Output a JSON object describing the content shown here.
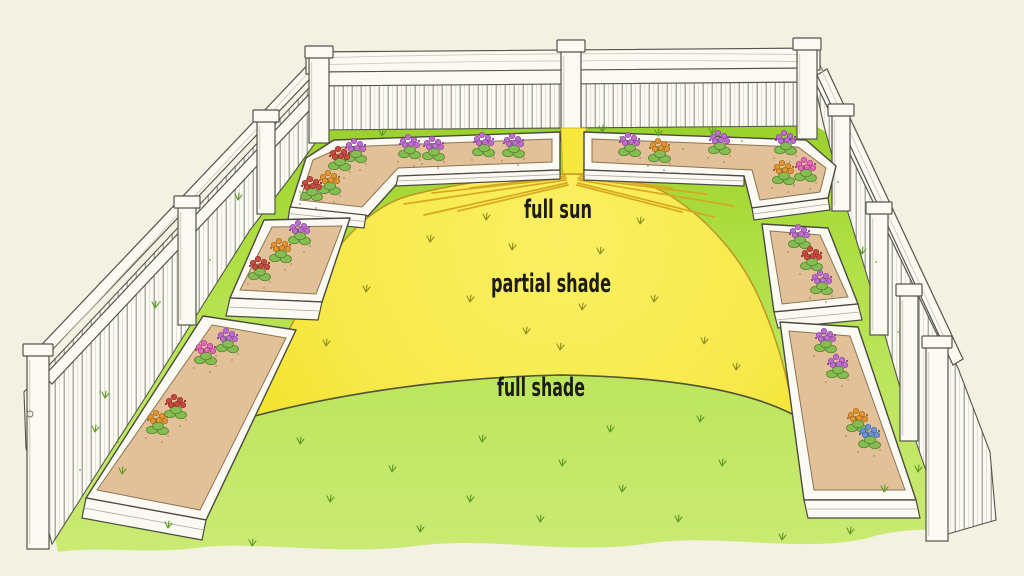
{
  "figure": {
    "type": "garden sun exposure diagram",
    "zones": [
      {
        "id": "full-sun",
        "label": "full sun"
      },
      {
        "id": "partial-shade",
        "label": "partial shade"
      },
      {
        "id": "full-shade",
        "label": "full shade"
      }
    ],
    "palette": {
      "background": "#f2f1e2",
      "grass_back": "#9ad02b",
      "grass_mid": "#b6e253",
      "grass_front": "#cbea74",
      "sun_yellow": "#f6e83d",
      "sun_yellow_light": "#faef62",
      "sun_outline": "#bf9522",
      "shade_line": "#4f5537",
      "ray": "#d8a81f",
      "fence_white": "#fbfaf2",
      "fence_line": "#54544a",
      "fence_shade": "#d8d7c9",
      "soil": "#e3c198",
      "soil_edge": "#8a7354",
      "soil_speck": "#b08a5a",
      "foliage": "#85bd52",
      "foliage_dark": "#4d7c28",
      "flower_purple": "#bd6fd0",
      "flower_pink": "#e06db8",
      "flower_red": "#c84a42",
      "flower_orange": "#e2962f",
      "flower_blue": "#6d94d6",
      "tuft_green": "#5d9b28",
      "tuft_yellow": "#8f8e1f",
      "label_ink": "#1d1c18"
    },
    "beds": [
      {
        "id": "bed-back-left",
        "flowers": [
          "purple",
          "red",
          "purple",
          "purple",
          "purple",
          "purple",
          "orange",
          "red"
        ]
      },
      {
        "id": "bed-back-right",
        "flowers": [
          "purple",
          "orange",
          "purple",
          "purple",
          "orange",
          "pink"
        ]
      },
      {
        "id": "bed-mid-left",
        "flowers": [
          "purple",
          "orange",
          "red"
        ]
      },
      {
        "id": "bed-bottom-left",
        "flowers": [
          "purple",
          "pink",
          "red",
          "orange"
        ]
      },
      {
        "id": "bed-mid-right",
        "flowers": [
          "purple",
          "red",
          "purple"
        ]
      },
      {
        "id": "bed-bottom-right",
        "flowers": [
          "purple",
          "purple",
          "orange",
          "blue"
        ]
      }
    ]
  }
}
